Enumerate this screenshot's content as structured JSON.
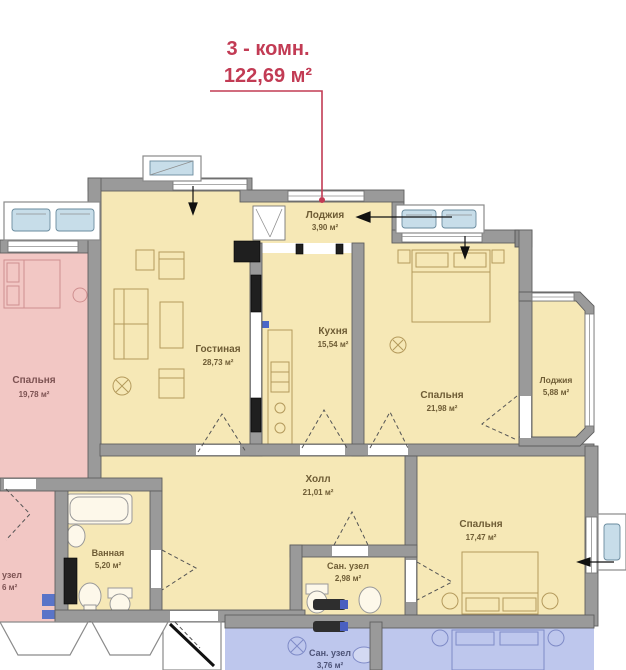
{
  "annotation": {
    "line1": "3 - комн.",
    "line2": "122,69 м²",
    "accent_color": "#c23b54"
  },
  "rooms": [
    {
      "id": "loggia-top",
      "name": "Лоджия",
      "area": "3,90 м²"
    },
    {
      "id": "living-room",
      "name": "Гостиная",
      "area": "28,73 м²"
    },
    {
      "id": "kitchen",
      "name": "Кухня",
      "area": "15,54 м²"
    },
    {
      "id": "bedroom-right",
      "name": "Спальня",
      "area": "21,98 м²"
    },
    {
      "id": "loggia-right",
      "name": "Лоджия",
      "area": "5,88 м²"
    },
    {
      "id": "bedroom-left",
      "name": "Спальня",
      "area": "19,78 м²"
    },
    {
      "id": "hall",
      "name": "Холл",
      "area": "21,01 м²"
    },
    {
      "id": "bathroom",
      "name": "Ванная",
      "area": "5,20 м²"
    },
    {
      "id": "bedroom-bottom",
      "name": "Спальня",
      "area": "17,47 м²"
    },
    {
      "id": "wc",
      "name": "Сан. узел",
      "area": "2,98 м²"
    },
    {
      "id": "wc-lower",
      "name": "Сан. узел",
      "area": "3,76 м²"
    },
    {
      "id": "wc-neighbor-fragment",
      "name": "узел",
      "area": "6 м²"
    }
  ],
  "colors": {
    "apartment_fill": "#f6e8b6",
    "neighbor_left_fill": "#f2c7c4",
    "neighbor_bottom_fill": "#bec7ed",
    "wall": "#9a9a9a",
    "wall_edge": "#5f5f5f",
    "glass": "#cfe2ee",
    "label": "#6e5c35",
    "label_pink": "#7d5353",
    "label_blue": "#4d5377"
  }
}
